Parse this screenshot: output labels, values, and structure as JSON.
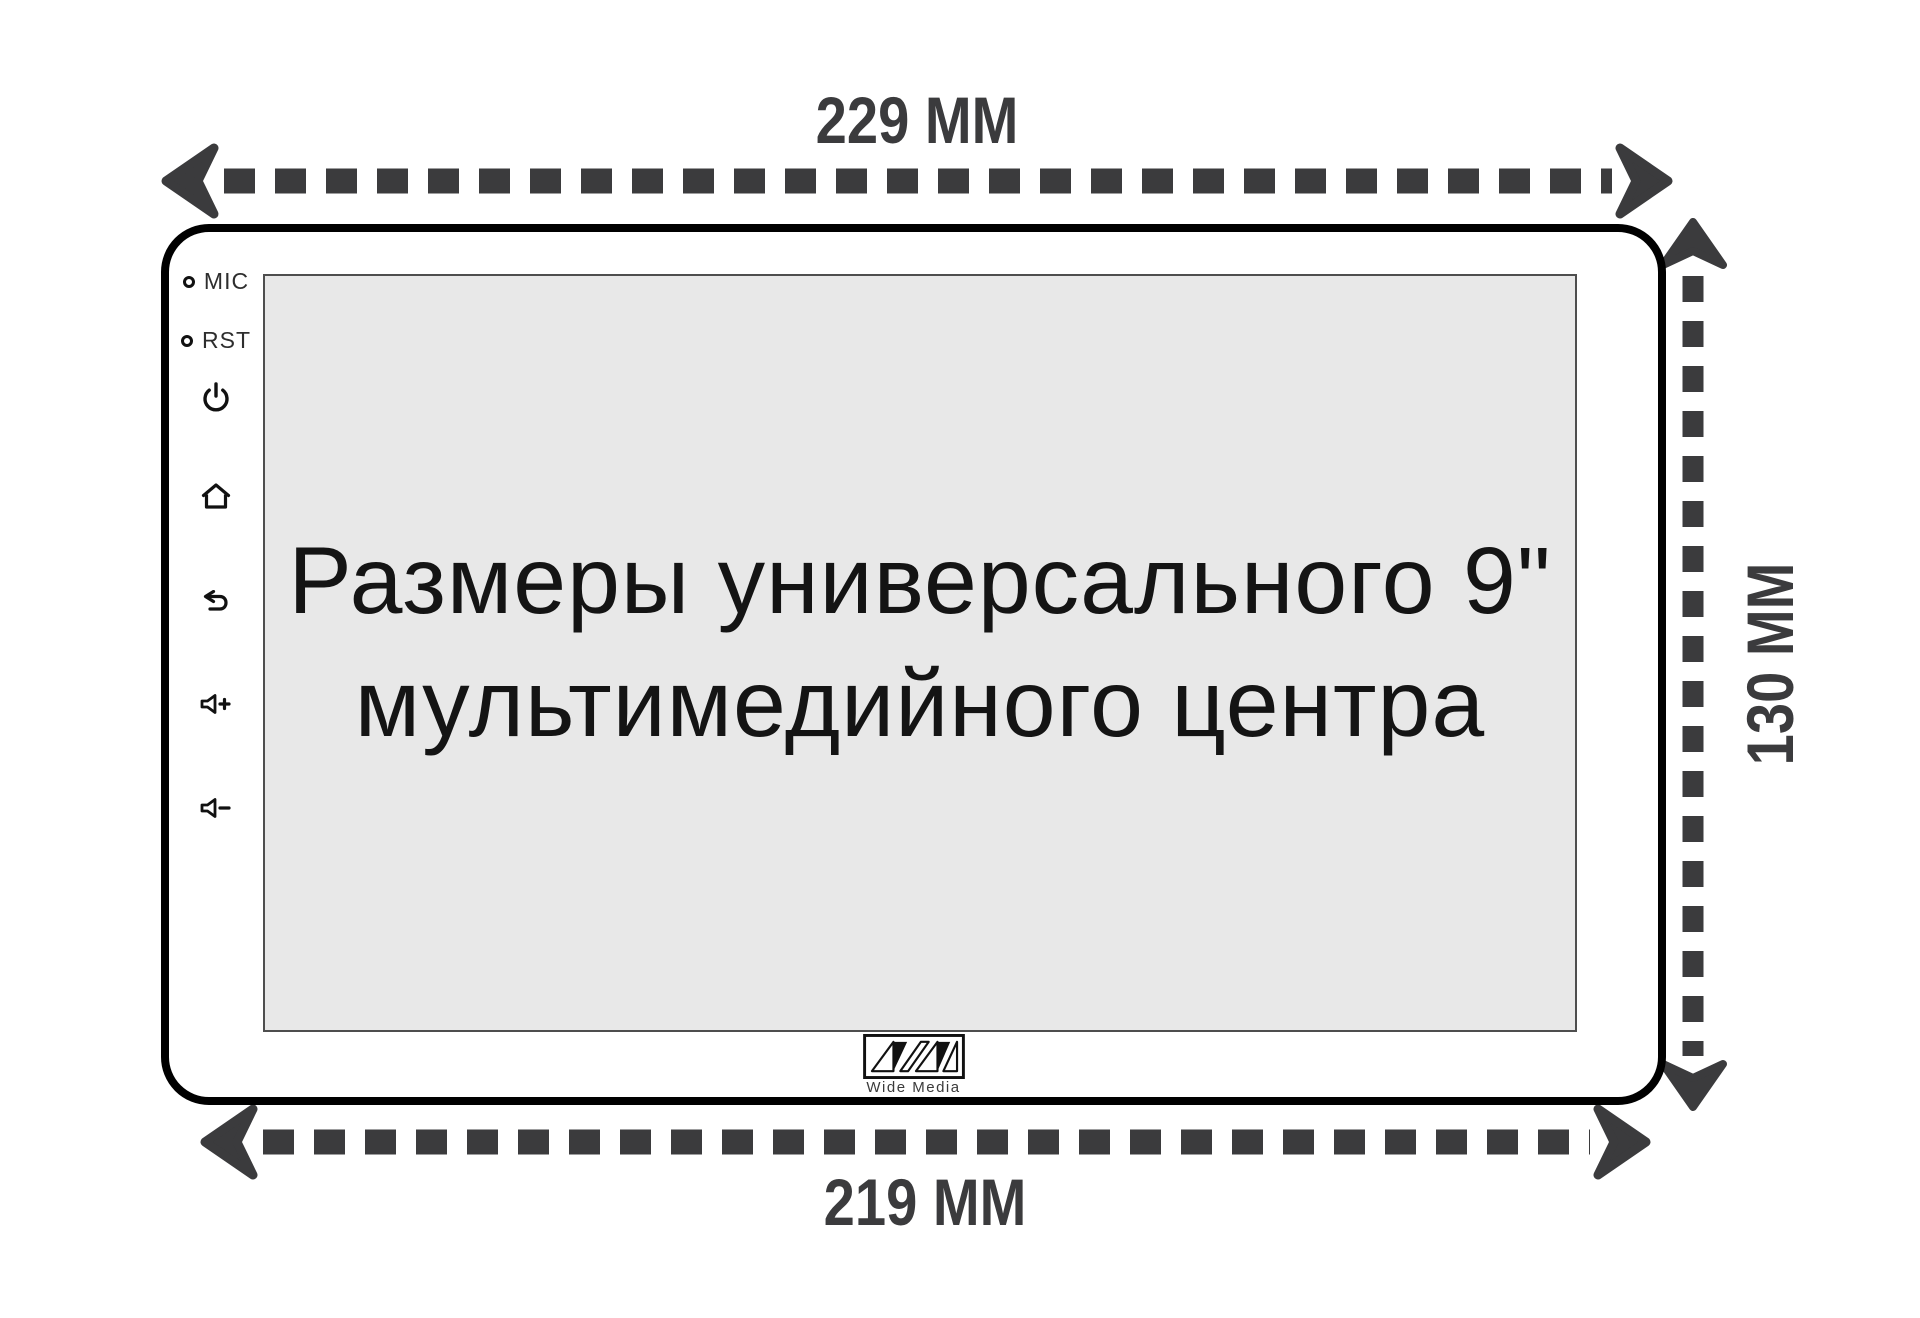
{
  "diagram_title": {
    "line1": "Размеры универсального 9\"",
    "line2": "мультимедийного центра"
  },
  "dimensions": {
    "top_width": "229 MM",
    "bottom_width": "219 MM",
    "height": "130 MM"
  },
  "device": {
    "ports": [
      {
        "label": "MIC"
      },
      {
        "label": "RST"
      }
    ],
    "button_icons": [
      "power-icon",
      "home-icon",
      "back-arrow-icon",
      "volume-up-icon",
      "volume-down-icon"
    ],
    "brand": "Wide Media"
  },
  "colors": {
    "dimension_lines": "#3b3b3d",
    "device_outline": "#000000",
    "screen_fill": "#e8e8e8",
    "screen_border": "#4e4e4e",
    "icon": "#111111",
    "background": "#ffffff"
  }
}
